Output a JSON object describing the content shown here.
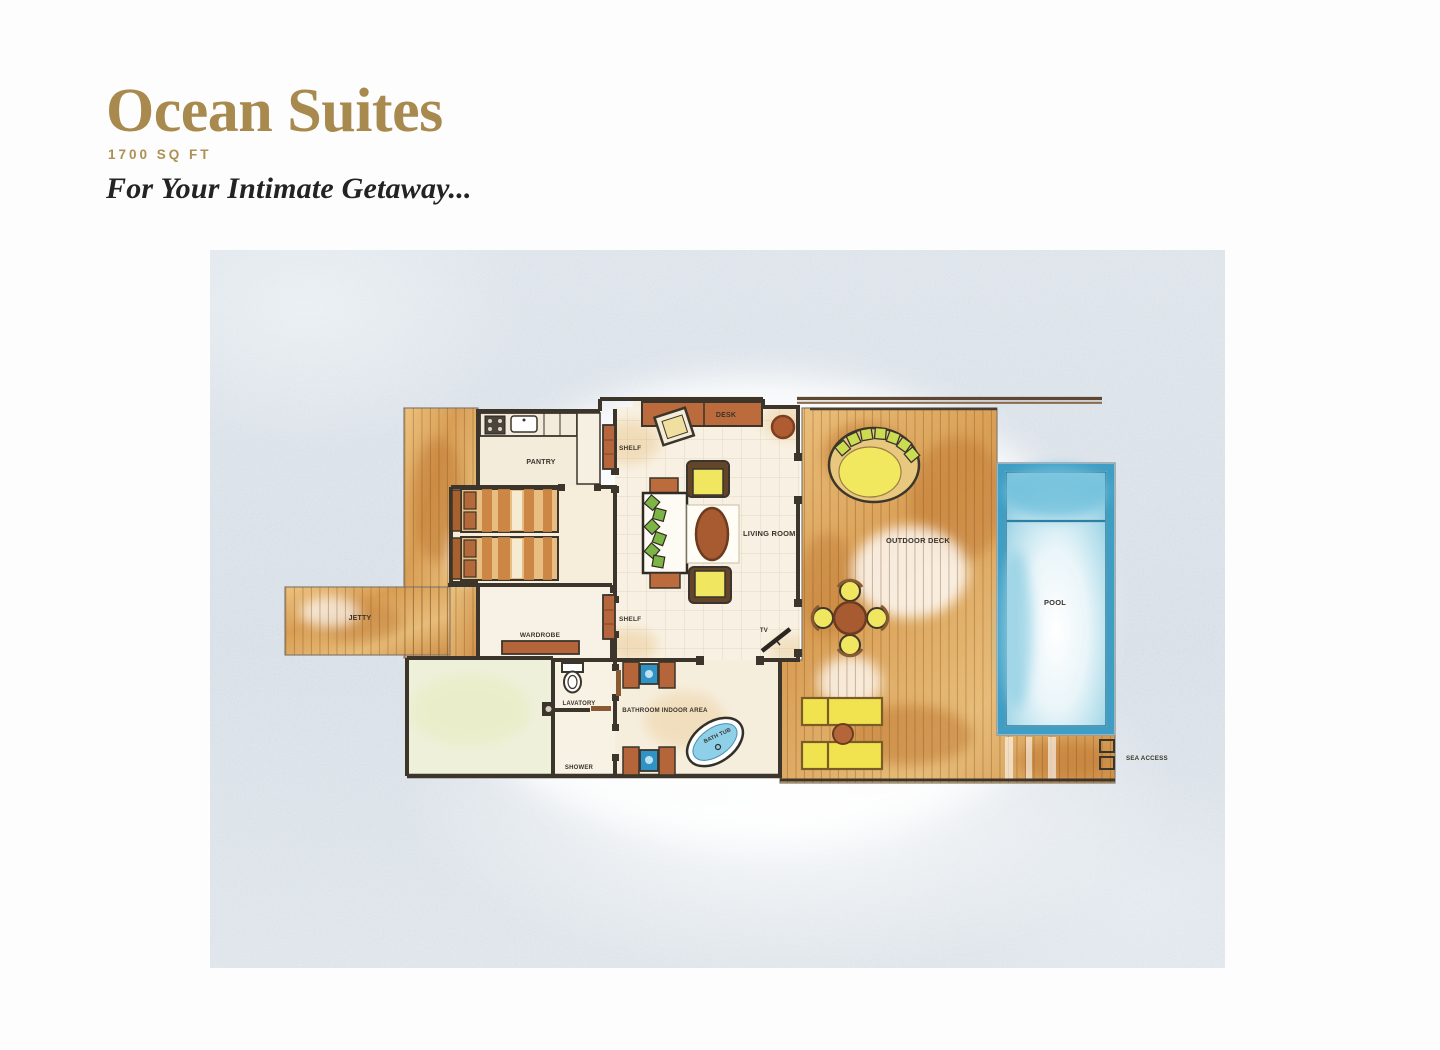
{
  "header": {
    "title": "Ocean Suites",
    "area": "1700 SQ FT",
    "tagline": "For Your Intimate Getaway..."
  },
  "plan": {
    "labels": {
      "pantry": "PANTRY",
      "shelf_top": "SHELF",
      "desk": "DESK",
      "living_room": "LIVING ROOM",
      "outdoor_deck": "OUTDOOR DECK",
      "pool": "POOL",
      "jetty": "JETTY",
      "wardrobe": "WARDROBE",
      "shelf_bottom": "SHELF",
      "tv": "TV",
      "lavatory": "LAVATORY",
      "shower": "SHOWER",
      "bathroom_indoor_area": "BATHROOM INDOOR AREA",
      "bath_tub": "BATH TUB",
      "sea_access": "SEA ACCESS"
    },
    "colors": {
      "accent_gold": "#a8894e",
      "wall": "#3b352b",
      "deck_wood": "#d9a35d",
      "furniture_brown": "#b4653a",
      "cushion_yellow": "#f1e65f",
      "pillow_green": "#7cb544",
      "pool_rim": "#3e9ec4",
      "pool_water": "#7cc4dc",
      "figure_background": "#d9e0e7"
    }
  }
}
